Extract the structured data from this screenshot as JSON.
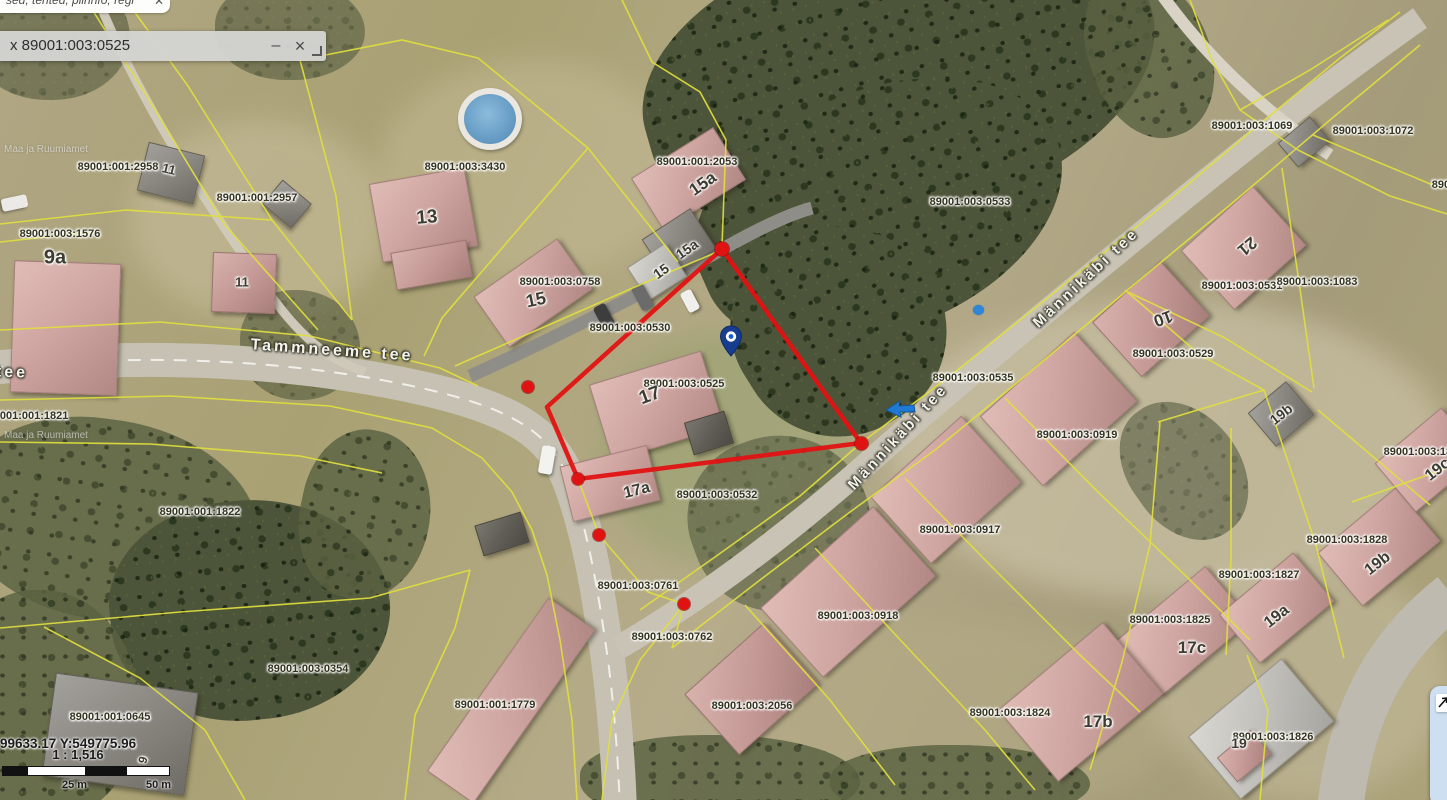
{
  "topbar": {
    "text_fragment": "sed, tehted, piirinfo, regi",
    "close_icon": "✕"
  },
  "popup": {
    "title": "x 89001:003:0525",
    "minimize_icon": "–",
    "close_icon": "×"
  },
  "statusbar": {
    "coordinates": "99633.17 Y:549775.96",
    "scale_ratio": "1 : 1,516",
    "tick_25": "25 m",
    "tick_50": "50 m"
  },
  "watermark": "Maa ja Ruumiamet",
  "map": {
    "highlighted_parcel": "89001:003:0525",
    "colors": {
      "boundary_yellow": "#e0df3e",
      "highlight_red": "#e11212",
      "pin_blue": "#183d8f"
    },
    "street_labels": [
      {
        "text": "Tammneeme tee",
        "x": 332,
        "y": 351,
        "rot": 4,
        "s": 16
      },
      {
        "text": "Männikäbi tee",
        "x": 1086,
        "y": 278,
        "rot": -43,
        "s": 15
      },
      {
        "text": "Männikäbi tee",
        "x": 898,
        "y": 437,
        "rot": -47,
        "s": 15
      },
      {
        "text": "tee",
        "x": 12,
        "y": 373,
        "rot": 2,
        "s": 16
      }
    ],
    "parcel_labels": [
      {
        "text": "89001:001:2958",
        "x": 118,
        "y": 167
      },
      {
        "text": "89001:001:2957",
        "x": 257,
        "y": 198
      },
      {
        "text": "89001:003:1576",
        "x": 60,
        "y": 234
      },
      {
        "text": "89001:003:3430",
        "x": 465,
        "y": 167
      },
      {
        "text": "89001:003:0758",
        "x": 560,
        "y": 282
      },
      {
        "text": "89001:001:2053",
        "x": 697,
        "y": 162
      },
      {
        "text": "89001:003:0533",
        "x": 970,
        "y": 202
      },
      {
        "text": "89001:003:1069",
        "x": 1252,
        "y": 126
      },
      {
        "text": "89001:003:1072",
        "x": 1373,
        "y": 131
      },
      {
        "text": "8900",
        "x": 1444,
        "y": 185
      },
      {
        "text": "89001:003:0531",
        "x": 1242,
        "y": 286
      },
      {
        "text": "89001:003:1083",
        "x": 1317,
        "y": 282
      },
      {
        "text": "89001:003:0529",
        "x": 1173,
        "y": 354
      },
      {
        "text": "89001:003:0535",
        "x": 973,
        "y": 378
      },
      {
        "text": "89001:003:0919",
        "x": 1077,
        "y": 435
      },
      {
        "text": "89001:003:1829",
        "x": 1424,
        "y": 452
      },
      {
        "text": "89001:003:0530",
        "x": 630,
        "y": 328
      },
      {
        "text": "89001:003:0525",
        "x": 684,
        "y": 384
      },
      {
        "text": "89001:003:0532",
        "x": 717,
        "y": 495
      },
      {
        "text": "89001:003:0917",
        "x": 960,
        "y": 530
      },
      {
        "text": "89001:003:1828",
        "x": 1347,
        "y": 540
      },
      {
        "text": "89001:003:1827",
        "x": 1259,
        "y": 575
      },
      {
        "text": "89001:003:1825",
        "x": 1170,
        "y": 620
      },
      {
        "text": "89001:003:0918",
        "x": 858,
        "y": 616
      },
      {
        "text": "89001:003:1824",
        "x": 1010,
        "y": 713
      },
      {
        "text": "89001:003:1826",
        "x": 1273,
        "y": 737
      },
      {
        "text": "89001:003:2056",
        "x": 752,
        "y": 706
      },
      {
        "text": "89001:001:1779",
        "x": 495,
        "y": 705
      },
      {
        "text": "89001:003:0354",
        "x": 308,
        "y": 669
      },
      {
        "text": "89001:001:0645",
        "x": 110,
        "y": 717
      },
      {
        "text": "89001:001:1822",
        "x": 200,
        "y": 512
      },
      {
        "text": "89001:001:1821",
        "x": 28,
        "y": 416
      },
      {
        "text": "89001:003:0761",
        "x": 638,
        "y": 586
      },
      {
        "text": "89001:003:0762",
        "x": 672,
        "y": 637
      }
    ],
    "house_labels": [
      {
        "text": "9a",
        "x": 55,
        "y": 258,
        "s": 20
      },
      {
        "text": "11",
        "x": 169,
        "y": 169,
        "rot": 14,
        "s": 13
      },
      {
        "text": "11",
        "x": 242,
        "y": 282,
        "s": 13
      },
      {
        "text": "13",
        "x": 427,
        "y": 218,
        "rot": -5,
        "s": 19
      },
      {
        "text": "15",
        "x": 536,
        "y": 300,
        "rot": -12,
        "s": 18
      },
      {
        "text": "15a",
        "x": 703,
        "y": 184,
        "rot": -35,
        "s": 17
      },
      {
        "text": "15a",
        "x": 687,
        "y": 249,
        "rot": -35,
        "s": 14
      },
      {
        "text": "15",
        "x": 661,
        "y": 271,
        "rot": -35,
        "s": 14
      },
      {
        "text": "17",
        "x": 650,
        "y": 396,
        "rot": -20,
        "s": 19
      },
      {
        "text": "17a",
        "x": 637,
        "y": 491,
        "rot": -14,
        "s": 16
      },
      {
        "text": "21",
        "x": 1247,
        "y": 246,
        "rot": 140,
        "s": 17
      },
      {
        "text": "10",
        "x": 1163,
        "y": 318,
        "rot": 160,
        "s": 17
      },
      {
        "text": "19b",
        "x": 1281,
        "y": 414,
        "rot": -38,
        "s": 14
      },
      {
        "text": "19c",
        "x": 1438,
        "y": 470,
        "rot": -38,
        "s": 16
      },
      {
        "text": "19b",
        "x": 1378,
        "y": 564,
        "rot": -38,
        "s": 16
      },
      {
        "text": "19a",
        "x": 1277,
        "y": 617,
        "rot": -38,
        "s": 16
      },
      {
        "text": "17c",
        "x": 1192,
        "y": 648,
        "s": 17
      },
      {
        "text": "17b",
        "x": 1098,
        "y": 722,
        "s": 17
      },
      {
        "text": "19",
        "x": 1239,
        "y": 743,
        "s": 14
      },
      {
        "text": "9",
        "x": 143,
        "y": 760,
        "rot": -75,
        "s": 12
      }
    ],
    "red_dots": [
      {
        "x": 722,
        "y": 249,
        "r": 14
      },
      {
        "x": 528,
        "y": 387,
        "r": 12
      },
      {
        "x": 578,
        "y": 479,
        "r": 12
      },
      {
        "x": 599,
        "y": 535,
        "r": 12
      },
      {
        "x": 684,
        "y": 604,
        "r": 12
      },
      {
        "x": 861,
        "y": 443,
        "r": 13
      }
    ]
  }
}
